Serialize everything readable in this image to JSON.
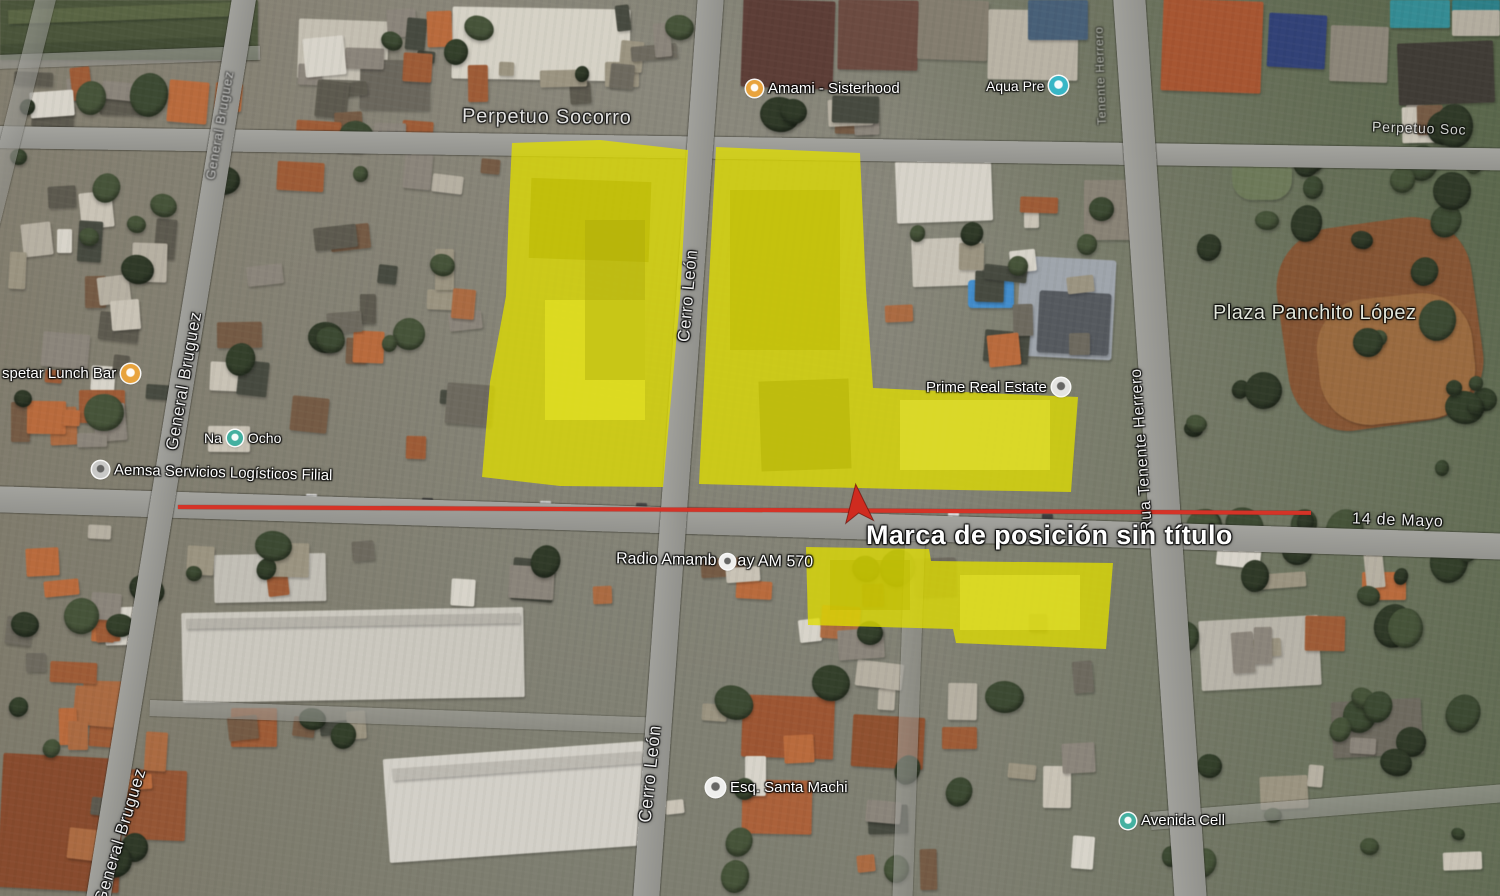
{
  "map": {
    "placemark_label": "Marca de posición sin título",
    "street_labels": {
      "perpetuo_socorro_left": "Perpetuo Socorro",
      "perpetuo_socorro_right": "Perpetuo Soc",
      "general_bruguez_top": "General Bruguez",
      "general_bruguez_upper": "General Bruguez",
      "general_bruguez_lower": "General Bruguez",
      "cerro_leon_upper": "Cerro León",
      "cerro_leon_lower": "Cerro León",
      "tenente_herrero_top": "Tenente Herrero",
      "tenente_herrero": "Rua Tenente Herrero",
      "catorce_de_mayo": "14 de Mayo"
    },
    "place_labels": {
      "lunch_bar": "spetar Lunch Bar",
      "amami": "Amami - Sisterhood",
      "aqua": "Aqua Pre",
      "na": "Na",
      "ocho": "Ocho",
      "aemsa": "Aemsa Servicios Logísticos Filial",
      "prime": "Prime Real Estate",
      "plaza": "Plaza Panchito López",
      "radio_left": "Radio Amamb",
      "radio_right": "ay AM 570",
      "esq": "Esq. Santa Machi",
      "avenida_cell": "Avenida Cell"
    },
    "colors": {
      "highlight_yellow": "#DFDD00",
      "route_red": "#D53327",
      "placemark_red": "#CF2B1F",
      "road_grey": "#9A9A96",
      "label_white": "#FFFFFF",
      "poi_orange": "#E8A33D",
      "poi_teal": "#38B6C6",
      "poi_green_teal": "#44B0A0"
    }
  }
}
